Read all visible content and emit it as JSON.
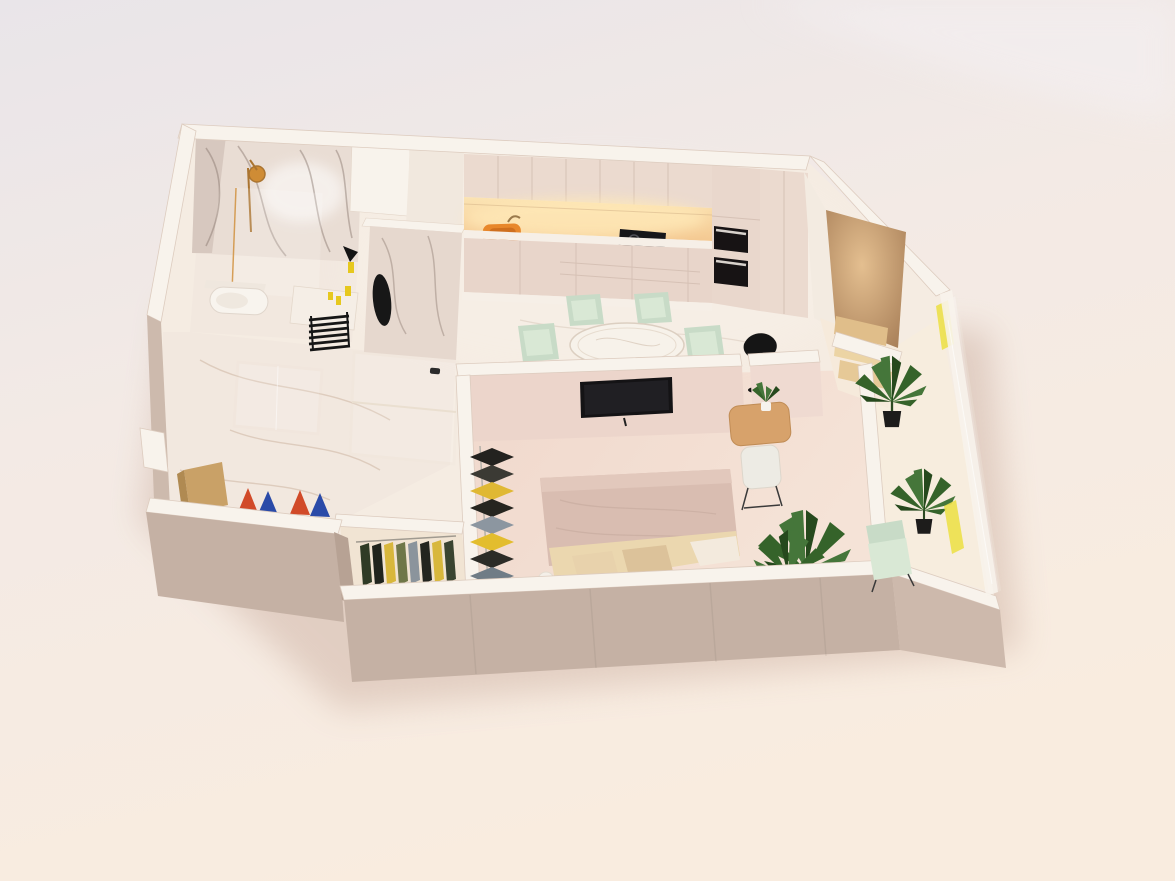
{
  "meta": {
    "kind": "photographed 3D isometric cutaway floor plan render",
    "visible_text": "none"
  },
  "background": {
    "top": "#e9e5e9",
    "mid": "#f3eae5",
    "bottom": "#f9ecdf"
  },
  "palette": {
    "shadow": "#c9ab9c",
    "wallTop": "#f8f3ec",
    "wallEdge": "#ddccbf",
    "wallOuterLeft": "#cdbaad",
    "wallOuterBottom": "#c5b1a4",
    "wallOuterBottom2": "#cdb9ac",
    "wallJog": "#b7a294",
    "floorBase": "#f5ece2",
    "floorMarble": "#f2e8df",
    "floorVein": "#c9af9b",
    "floorBedroom": "#f2dcd1",
    "floorCloset": "#f1e4d3",
    "floorBalcony": "#f7edde",
    "floorNook": "#f6eadb",
    "marbleWall": "#e9ddd4",
    "marbleVein": "#84736a",
    "marbleColumn": "#e6d8ce",
    "cabinet": "#ebdacf",
    "cabinetTall": "#e9d7cc",
    "cabinetSeam": "#d6c1b5",
    "baseCab": "#e8d5ca",
    "counterFront": "#f6efe7",
    "sink": "#e8872b",
    "sinkInner": "#cf6f1e",
    "hob": "#17171a",
    "oven": "#171314",
    "ovenHandle": "#d8d2cc",
    "tv": "#141315",
    "tvWall": "#ecd5cb",
    "tvWall2": "#efdad1",
    "table": "#f7f2ea",
    "tableEdge": "#dccfc1",
    "chairMint": "#c8dbc7",
    "chairMintSeat": "#d9e8d5",
    "lamp": "#151515",
    "duvet": "#d9bdb1",
    "duvetRoll": "#e2c8bc",
    "duvetFold": "#c3a89b",
    "blanket": "#ebd7af",
    "pillowLight": "#e8d2ac",
    "pillowDark": "#dcc29a",
    "sheet": "#f3eadd",
    "pouf": "#f4efe8",
    "desk": "#d7a26b",
    "deskEdge": "#c08c55",
    "chairWhite": "#edebe4",
    "accentCenter": "#e4bf90",
    "accentEdge": "#a87f58",
    "armBack": "#e0be8a",
    "armSeat": "#ecd4a4",
    "armOttoman": "#e6c997",
    "plantLight": "#45763a",
    "plantMid": "#35632a",
    "plantDark": "#26491d",
    "pot": "#1d1c1b",
    "potWhite": "#f6f3ee",
    "towelRail": "#161616",
    "showerGold": "#cf8c35",
    "showerGoldDark": "#aa7430",
    "bottleYellow": "#e6c81e",
    "mirror": "#171717",
    "doorHandle": "#2b2b2b",
    "glassFrame": "#eadfd0",
    "bench": "#c9a167",
    "curtain": "#ece04a",
    "clothesBedroom": [
      "#23221f",
      "#3b3a34",
      "#e0b833",
      "#26251f",
      "#8c96a0",
      "#e3bd2e",
      "#2c2b26",
      "#707c86"
    ],
    "clothesCloset": [
      "#2f3b26",
      "#20241d",
      "#d8b73c",
      "#6f7748",
      "#8b949c",
      "#23251f",
      "#d8b73c",
      "#3a4430"
    ],
    "shoes": [
      "#d14a28",
      "#2a4aa8",
      "#d14a28",
      "#2a4aa8"
    ]
  },
  "rooms": [
    {
      "name": "bathroom",
      "items": [
        "marble walls",
        "gold shower set",
        "glass shower screen",
        "wall-hung toilet",
        "vanity counter",
        "black oval mirror",
        "black towel ladder",
        "yellow toiletry bottles"
      ]
    },
    {
      "name": "kitchen",
      "items": [
        "upper cabinets",
        "illuminated backsplash",
        "orange sink",
        "black hob",
        "two built-in black ovens",
        "tall cabinet columns"
      ]
    },
    {
      "name": "living-dining",
      "items": [
        "round marble dining table",
        "four mint chairs",
        "black floor lamp",
        "marble floor"
      ]
    },
    {
      "name": "entry-nook",
      "items": [
        "brown accent wall",
        "beige lounge chair with ottoman",
        "potted plant"
      ]
    },
    {
      "name": "hallway",
      "items": [
        "marble floor",
        "glass partition doors",
        "wooden bench",
        "red and blue shoes"
      ]
    },
    {
      "name": "walk-in-closet",
      "items": [
        "clothes rail with hanging garments"
      ]
    },
    {
      "name": "bedroom",
      "items": [
        "double bed with pink duvet",
        "wall-mounted TV",
        "wooden desk with plant",
        "white desk chair",
        "open clothes rack",
        "large potted plant"
      ]
    },
    {
      "name": "balcony",
      "items": [
        "glass railing",
        "mint armchair",
        "potted plant",
        "yellow curtains"
      ]
    }
  ]
}
